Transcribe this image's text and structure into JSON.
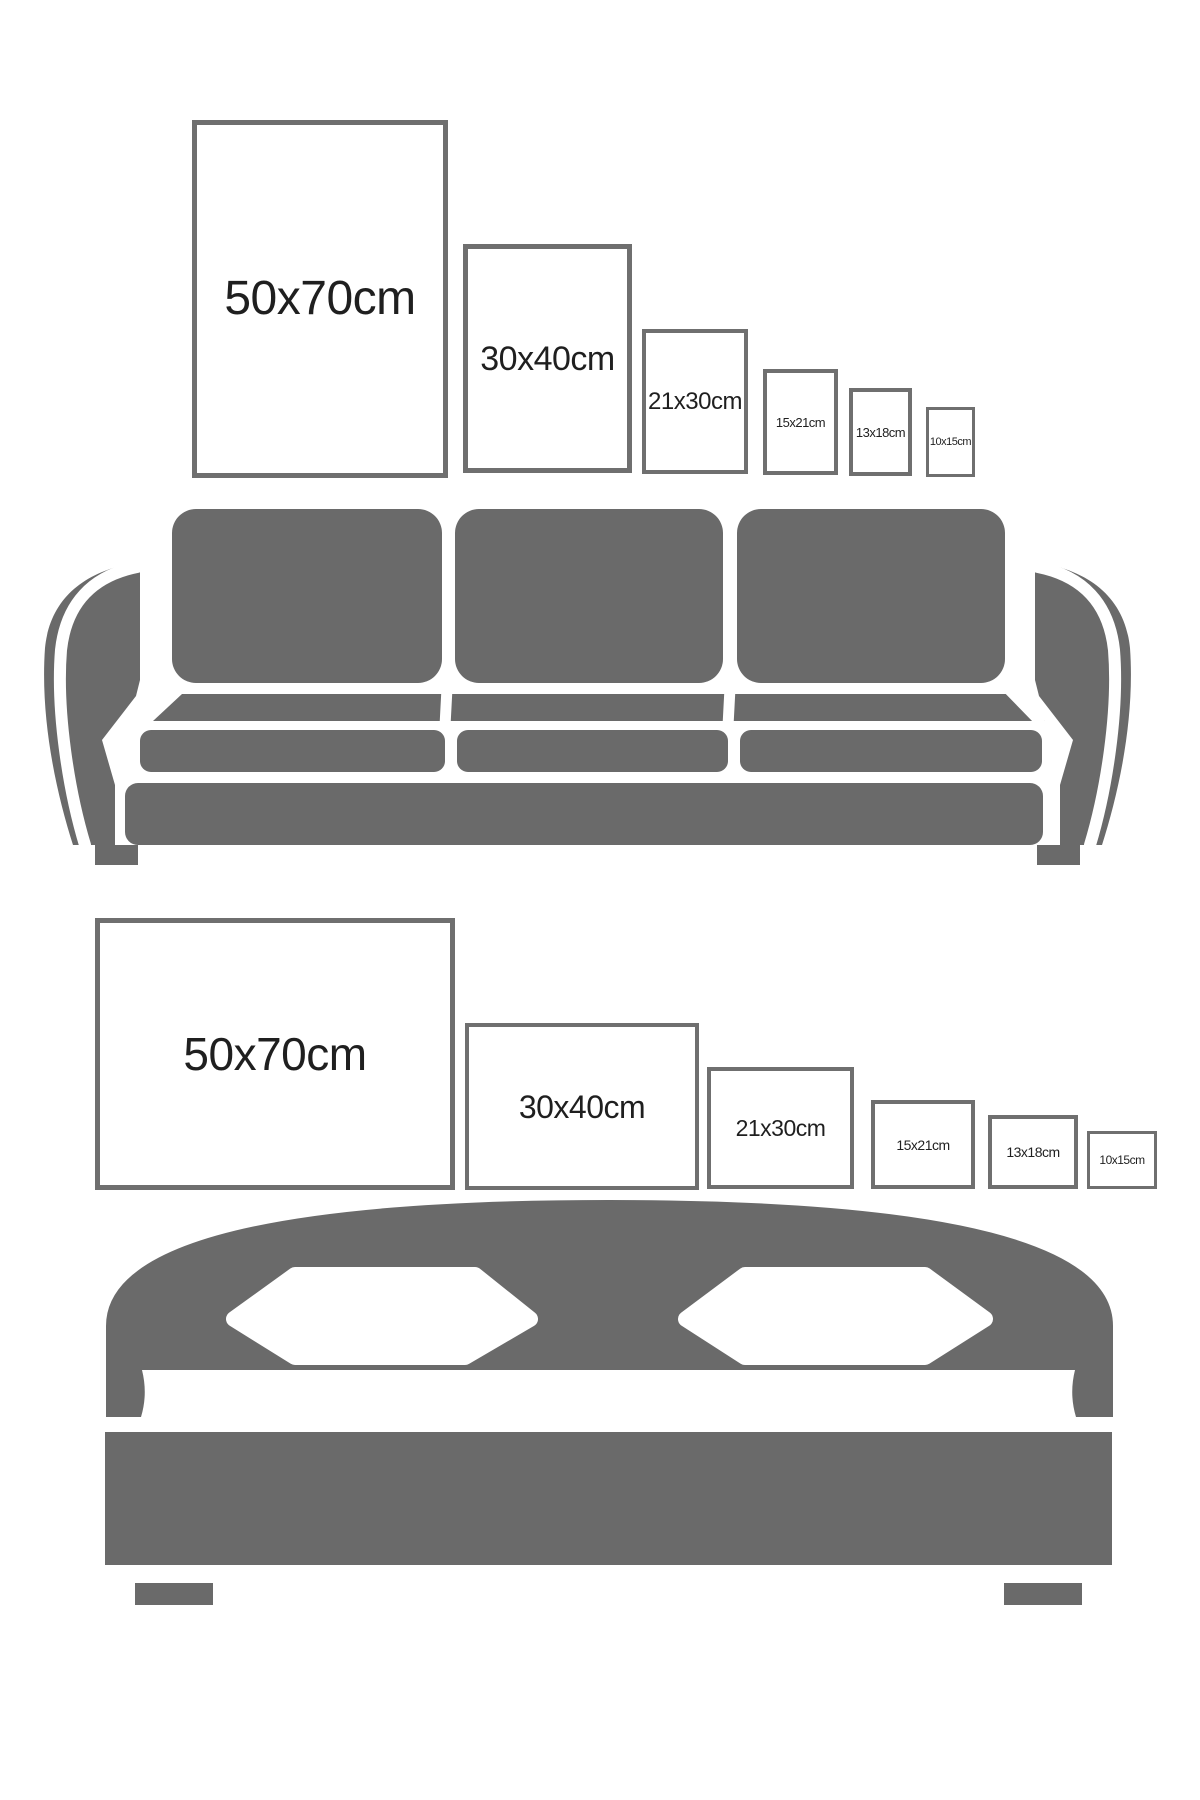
{
  "sections": {
    "top": {
      "furniture": "sofa",
      "orientation": "portrait",
      "frames": [
        {
          "label": "50x70cm"
        },
        {
          "label": "30x40cm"
        },
        {
          "label": "21x30cm"
        },
        {
          "label": "15x21cm"
        },
        {
          "label": "13x18cm"
        },
        {
          "label": "10x15cm"
        }
      ]
    },
    "bottom": {
      "furniture": "bed",
      "orientation": "landscape",
      "frames": [
        {
          "label": "50x70cm"
        },
        {
          "label": "30x40cm"
        },
        {
          "label": "21x30cm"
        },
        {
          "label": "15x21cm"
        },
        {
          "label": "13x18cm"
        },
        {
          "label": "10x15cm"
        }
      ]
    }
  },
  "colors": {
    "furniture_gray": "#6a6a6a",
    "frame_border": "#6f6f6f",
    "label_text": "#1f1f1f",
    "background": "#ffffff"
  }
}
